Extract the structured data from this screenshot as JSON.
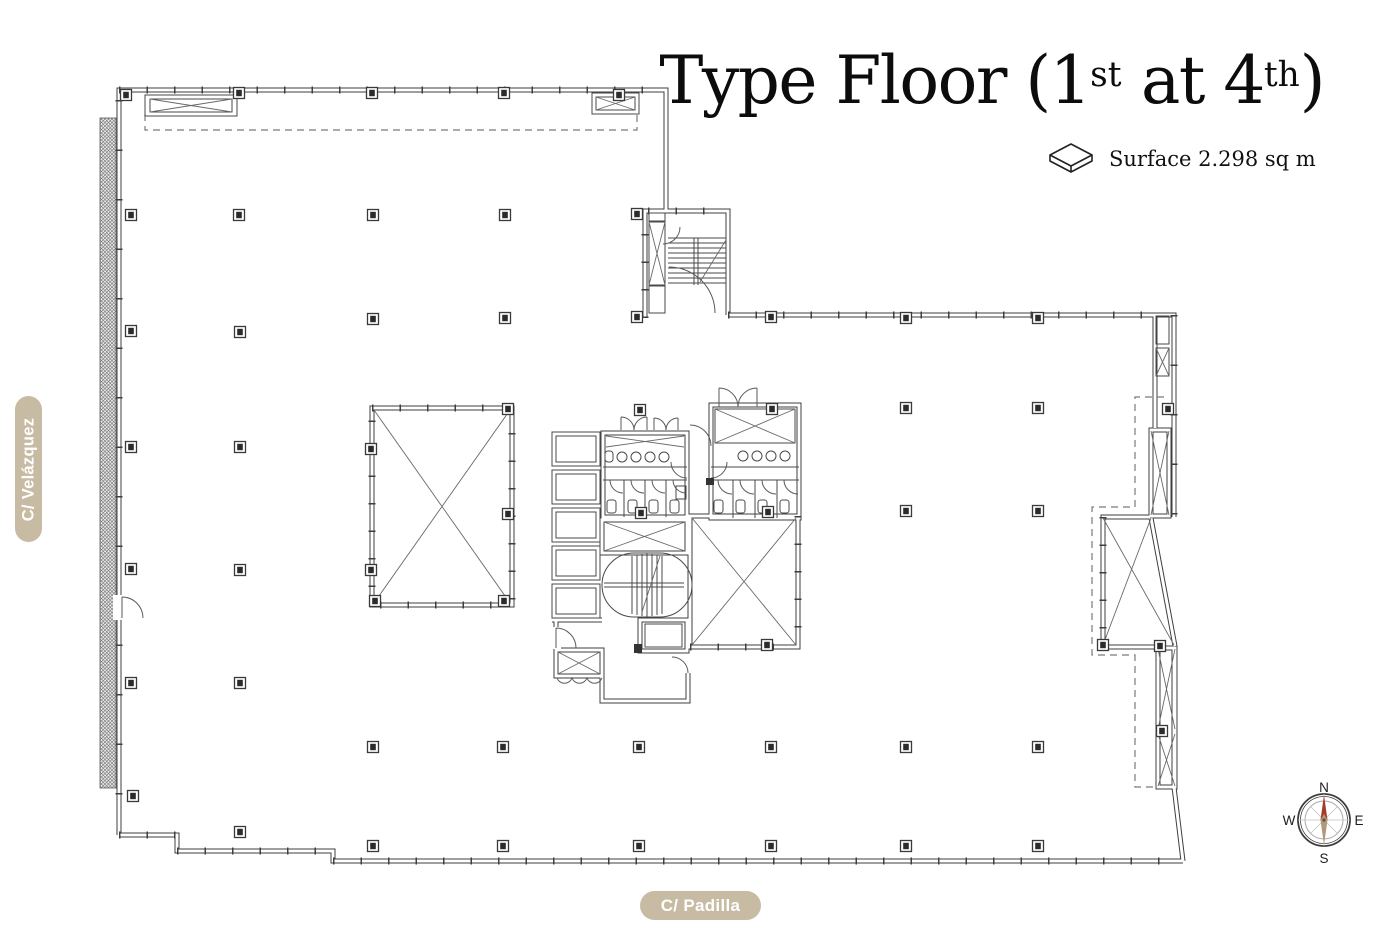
{
  "header": {
    "title": {
      "part1": "Type Floor (1",
      "sup1": "st",
      "part2": " at 4",
      "sup2": "th",
      "part3": ")"
    },
    "surface_label": "Surface 2.298 sq m"
  },
  "streets": {
    "left": "C/ Velázquez",
    "bottom": "C/ Padilla"
  },
  "compass": {
    "n": "N",
    "e": "E",
    "s": "S",
    "w": "W"
  },
  "colors": {
    "street_pill_bg": "#c8bba3",
    "street_pill_text": "#ffffff",
    "title_text": "#0c0c0c",
    "plan_line": "#3f3f3f",
    "compass_needle_north": "#a93a28",
    "compass_needle_south": "#b29878"
  }
}
